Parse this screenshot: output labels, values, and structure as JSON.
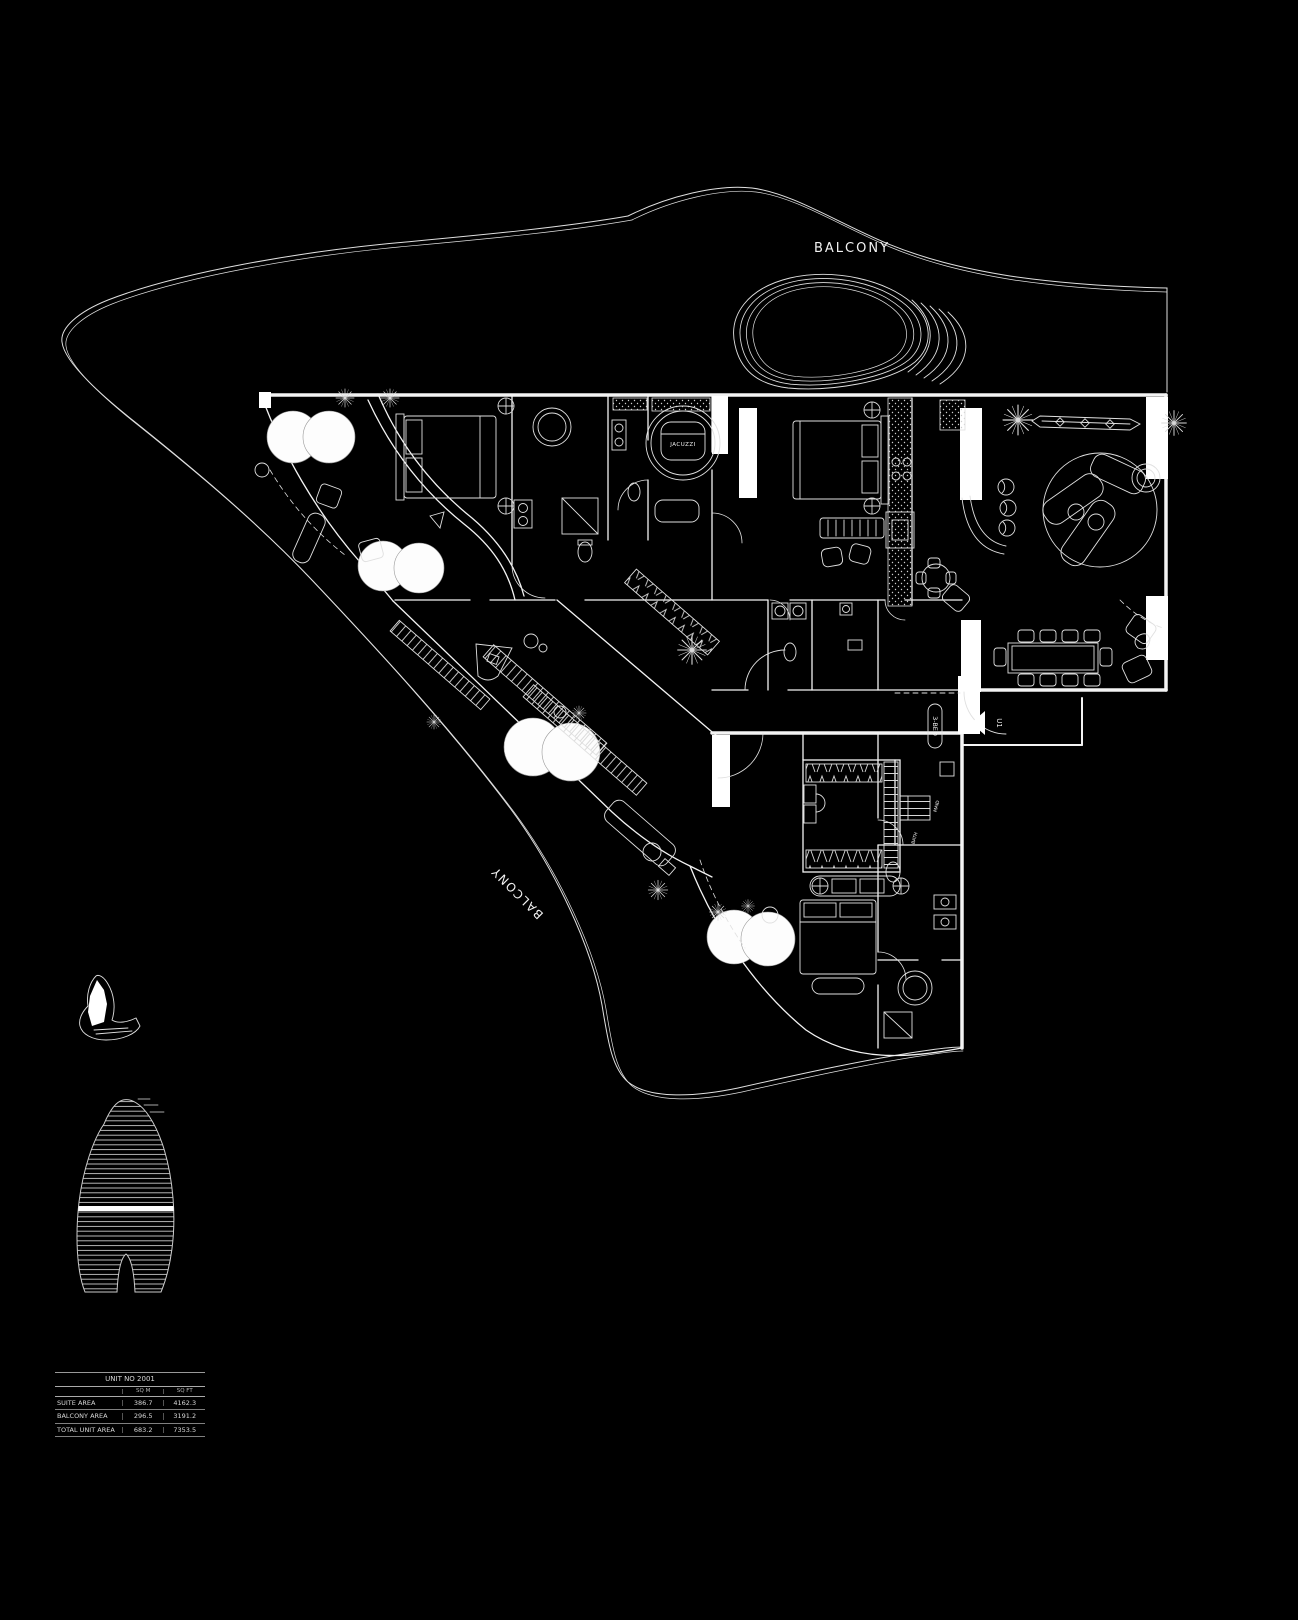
{
  "colors": {
    "background": "#000000",
    "line": "#e6e6e6",
    "bright": "#ffffff"
  },
  "plan": {
    "balcony_top": "BALCONY",
    "balcony_left": "BALCONY",
    "jacuzzi": "JACUZZI",
    "bed3": "3-BED",
    "entry": "U1",
    "maid": "MAID",
    "bath": "BATH"
  },
  "area_table": {
    "unit_title": "UNIT NO 2001",
    "col_sqm": "SQ M",
    "col_sqft": "SQ FT",
    "rows": [
      {
        "label": "SUITE AREA",
        "sqm": "386.7",
        "sqft": "4162.3"
      },
      {
        "label": "BALCONY AREA",
        "sqm": "296.5",
        "sqft": "3191.2"
      },
      {
        "label": "TOTAL UNIT AREA",
        "sqm": "683.2",
        "sqft": "7353.5"
      }
    ]
  }
}
